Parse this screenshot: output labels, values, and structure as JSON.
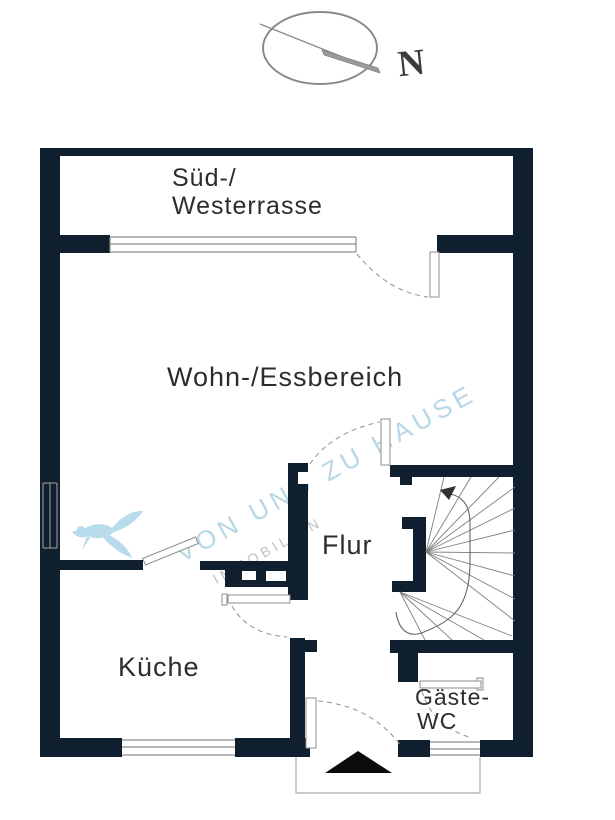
{
  "compass": {
    "north_label": "N"
  },
  "rooms": {
    "terrace": {
      "line1": "Süd-/",
      "line2": "Westerrasse"
    },
    "living": {
      "label": "Wohn-/Essbereich"
    },
    "hall": {
      "label": "Flur"
    },
    "kitchen": {
      "label": "Küche"
    },
    "guest_wc": {
      "line1": "Gäste-",
      "line2": "WC"
    }
  },
  "watermark": {
    "line1": "VON UND ZU HAUSE",
    "line2": "IMMOBILIEN"
  },
  "icons": {
    "compass": "compass-rose-icon",
    "north_needle": "north-needle-icon",
    "entrance": "entrance-arrow-icon",
    "staircase": "staircase-winder-icon",
    "logo": "bird-logo-icon",
    "chimney": "chimney-shaft-icon"
  },
  "colors": {
    "wall": "#101f2e",
    "line": "#8e8e8e",
    "text": "#2d2d2d",
    "watermark_blue": "#b7d6e6",
    "watermark_gray": "#b9c3ca",
    "bird_blue": "#b9dcec"
  }
}
